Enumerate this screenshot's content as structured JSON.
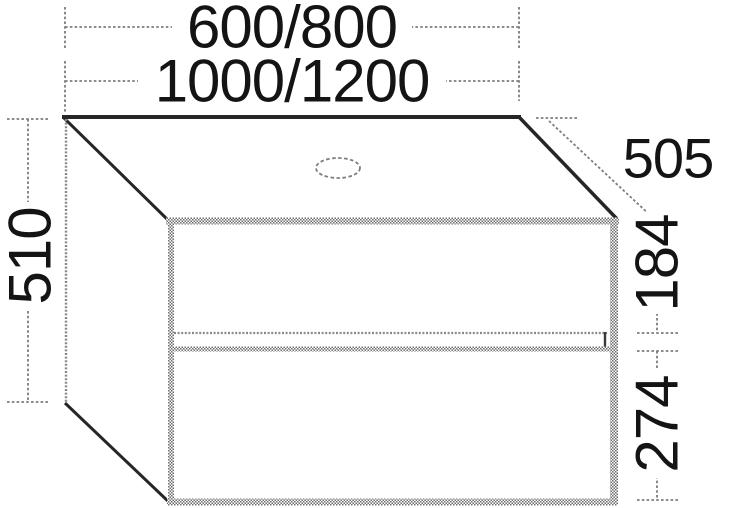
{
  "diagram": {
    "title": "vanity-unit-two-drawer-dimension-drawing",
    "dimension_labels": {
      "width_options_a": "600/800",
      "width_options_b": "1000/1200",
      "height_total": "510",
      "depth": "505",
      "upper_drawer_height": "184",
      "lower_drawer_height": "274"
    },
    "colors": {
      "edge_dark": "#262626",
      "panel_hatch_gray": "#6f6f6f",
      "dimension_gray": "#7d7d7d",
      "text": "#141414",
      "background": "#ffffff"
    }
  }
}
